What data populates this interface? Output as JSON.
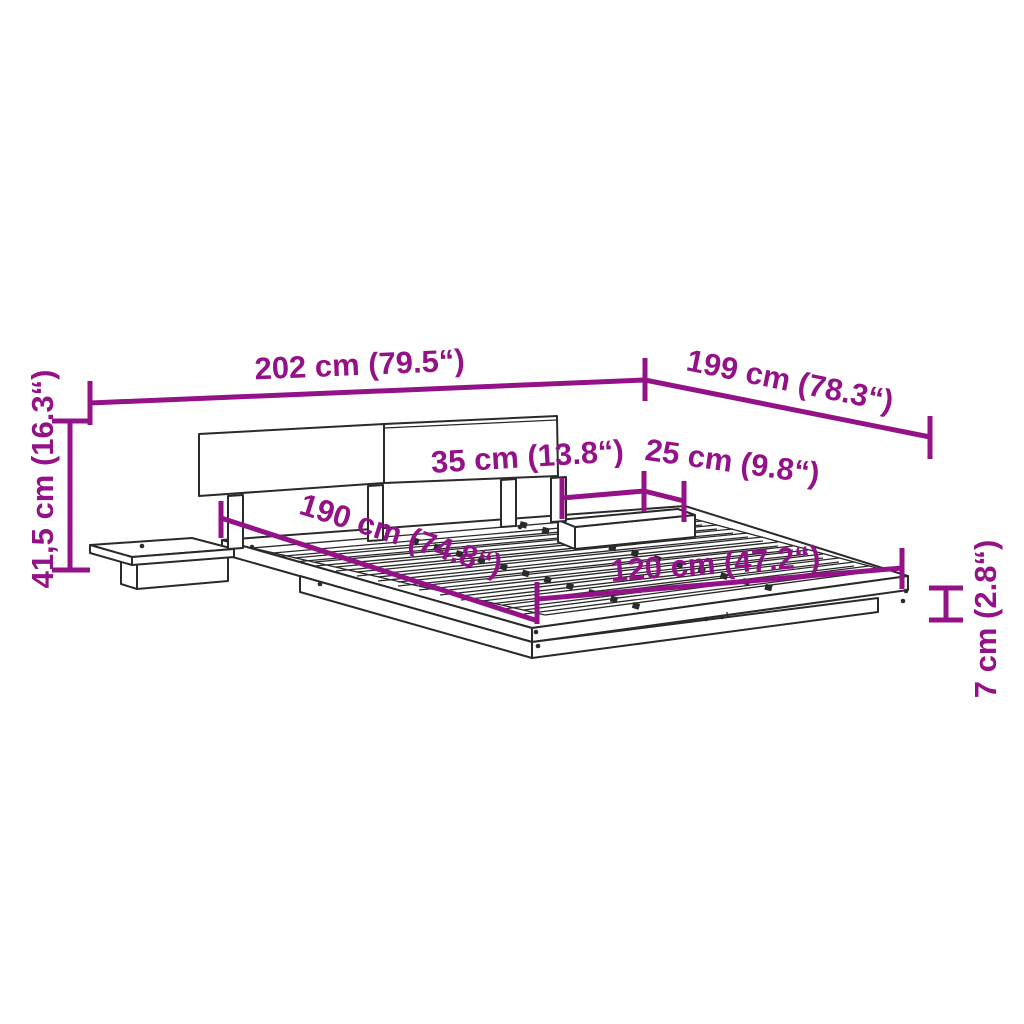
{
  "title": "Bed frame with headboard and floating nightstands — dimension diagram",
  "colors": {
    "accent": "#941287",
    "line": "#2a2a2a",
    "background": "#ffffff"
  },
  "dimensions": [
    {
      "name": "overall-width",
      "label": "202 cm (79.5“)"
    },
    {
      "name": "overall-depth",
      "label": "199 cm (78.3“)"
    },
    {
      "name": "total-height",
      "label": "41,5 cm (16.3“)"
    },
    {
      "name": "nightstand-width",
      "label": "35 cm (13.8“)"
    },
    {
      "name": "nightstand-depth",
      "label": "25 cm (9.8“)"
    },
    {
      "name": "bed-length",
      "label": "190 cm (74.8“)"
    },
    {
      "name": "bed-width",
      "label": "120 cm (47.2“)"
    },
    {
      "name": "frame-height",
      "label": "7 cm (2.8“)"
    }
  ]
}
